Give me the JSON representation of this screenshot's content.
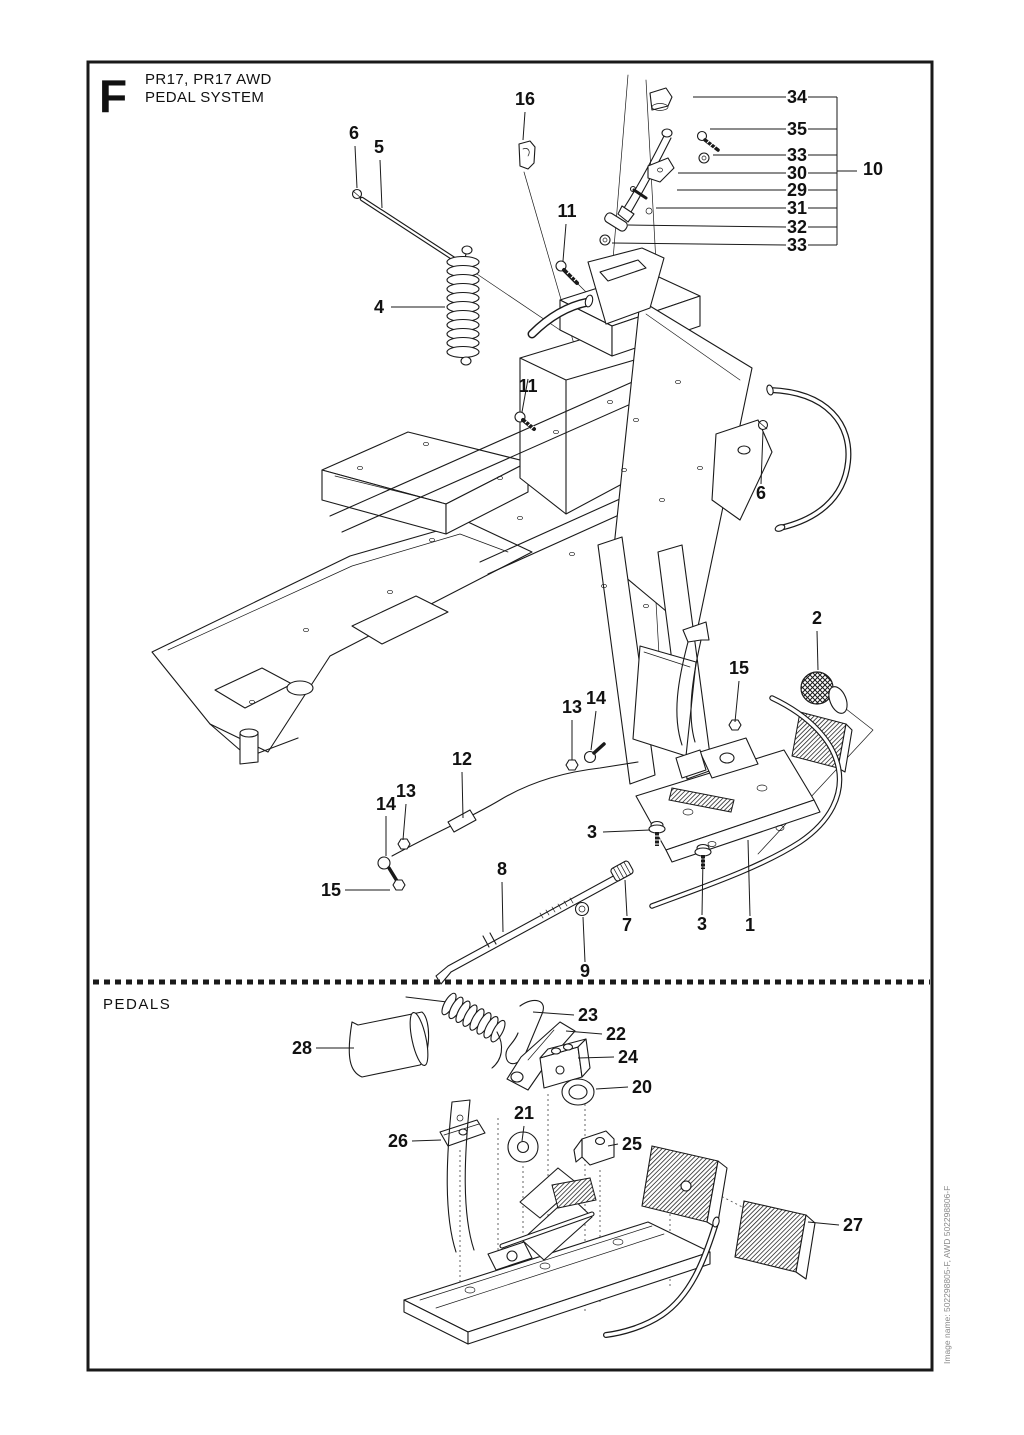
{
  "page": {
    "figure_letter": "F",
    "title_line1": "PR17, PR17 AWD",
    "title_line2": "PEDAL SYSTEM",
    "section_label": "PEDALS",
    "side_note": "Image name: 502298805-F, AWD 502298806-F",
    "ink": "#1a1a1a",
    "background": "#ffffff"
  },
  "callouts": [
    {
      "label": "16"
    },
    {
      "label": "6"
    },
    {
      "label": "5"
    },
    {
      "label": "11"
    },
    {
      "label": "34"
    },
    {
      "label": "35"
    },
    {
      "label": "33"
    },
    {
      "label": "30"
    },
    {
      "label": "29"
    },
    {
      "label": "31"
    },
    {
      "label": "32"
    },
    {
      "label": "33"
    },
    {
      "label": "10"
    },
    {
      "label": "4"
    },
    {
      "label": "11"
    },
    {
      "label": "6"
    },
    {
      "label": "2"
    },
    {
      "label": "15"
    },
    {
      "label": "13"
    },
    {
      "label": "14"
    },
    {
      "label": "12"
    },
    {
      "label": "13"
    },
    {
      "label": "14"
    },
    {
      "label": "15"
    },
    {
      "label": "3"
    },
    {
      "label": "8"
    },
    {
      "label": "9"
    },
    {
      "label": "7"
    },
    {
      "label": "3"
    },
    {
      "label": "1"
    },
    {
      "label": "28"
    },
    {
      "label": "23"
    },
    {
      "label": "22"
    },
    {
      "label": "24"
    },
    {
      "label": "20"
    },
    {
      "label": "21"
    },
    {
      "label": "26"
    },
    {
      "label": "25"
    },
    {
      "label": "27"
    }
  ]
}
